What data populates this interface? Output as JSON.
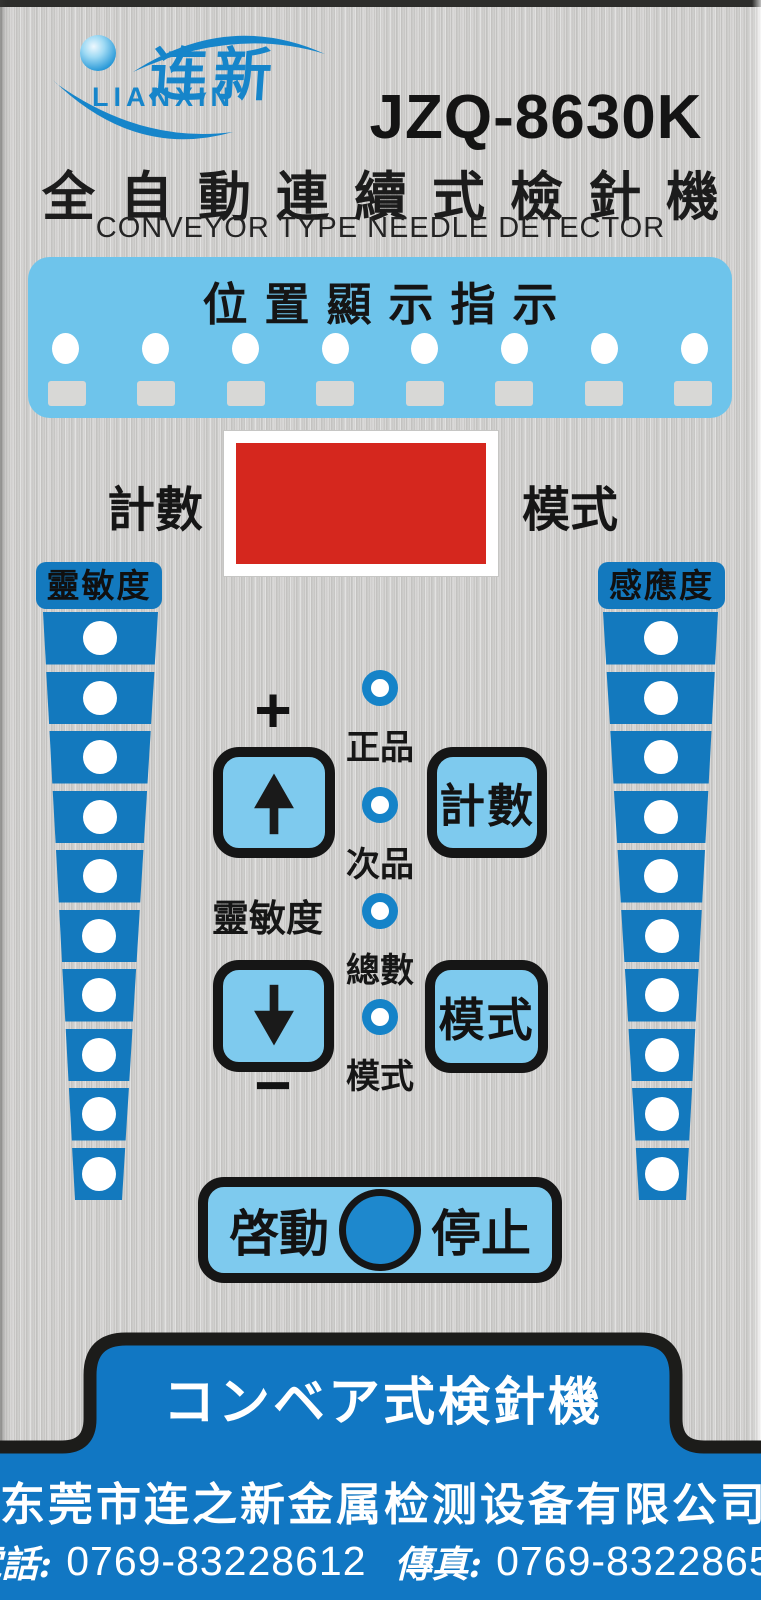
{
  "brand": {
    "logo_cn": "连新",
    "logo_en": "LIANXIN",
    "model": "JZQ-8630K"
  },
  "title": {
    "cn": "全自動連續式檢針機",
    "en": "CONVEYOR TYPE NEEDLE DETECTOR"
  },
  "position_panel": {
    "title": "位置顯示指示",
    "led_count": 8
  },
  "display": {
    "left_label": "計數",
    "right_label": "模式"
  },
  "ladders": {
    "left": {
      "label": "靈敏度",
      "levels": 10
    },
    "right": {
      "label": "感應度",
      "levels": 10
    }
  },
  "controls": {
    "plus_label": "+",
    "minus_label": "−",
    "sensitivity_label": "靈敏度",
    "count_button": "計數",
    "mode_button": "模式",
    "leds": [
      {
        "label": "正品"
      },
      {
        "label": "次品"
      },
      {
        "label": "總數"
      },
      {
        "label": "模式"
      }
    ]
  },
  "start_stop": {
    "start_label": "啓動",
    "stop_label": "停止"
  },
  "footer": {
    "tab_text": "コンベア式検針機",
    "company": "东莞市连之新金属检测设备有限公司",
    "phone_label": "電話:",
    "phone_number": "0769-83228612",
    "fax_label": "傳真:",
    "fax_number": "0769-83228650"
  },
  "colors": {
    "panel_blue": "#6ec4eb",
    "ladder_blue": "#1379be",
    "button_blue": "#7ecaee",
    "footer_blue": "#1177c3",
    "display_red": "#d5271e",
    "logo_blue": "#1685ca",
    "start_circle_blue": "#1e88cd"
  }
}
